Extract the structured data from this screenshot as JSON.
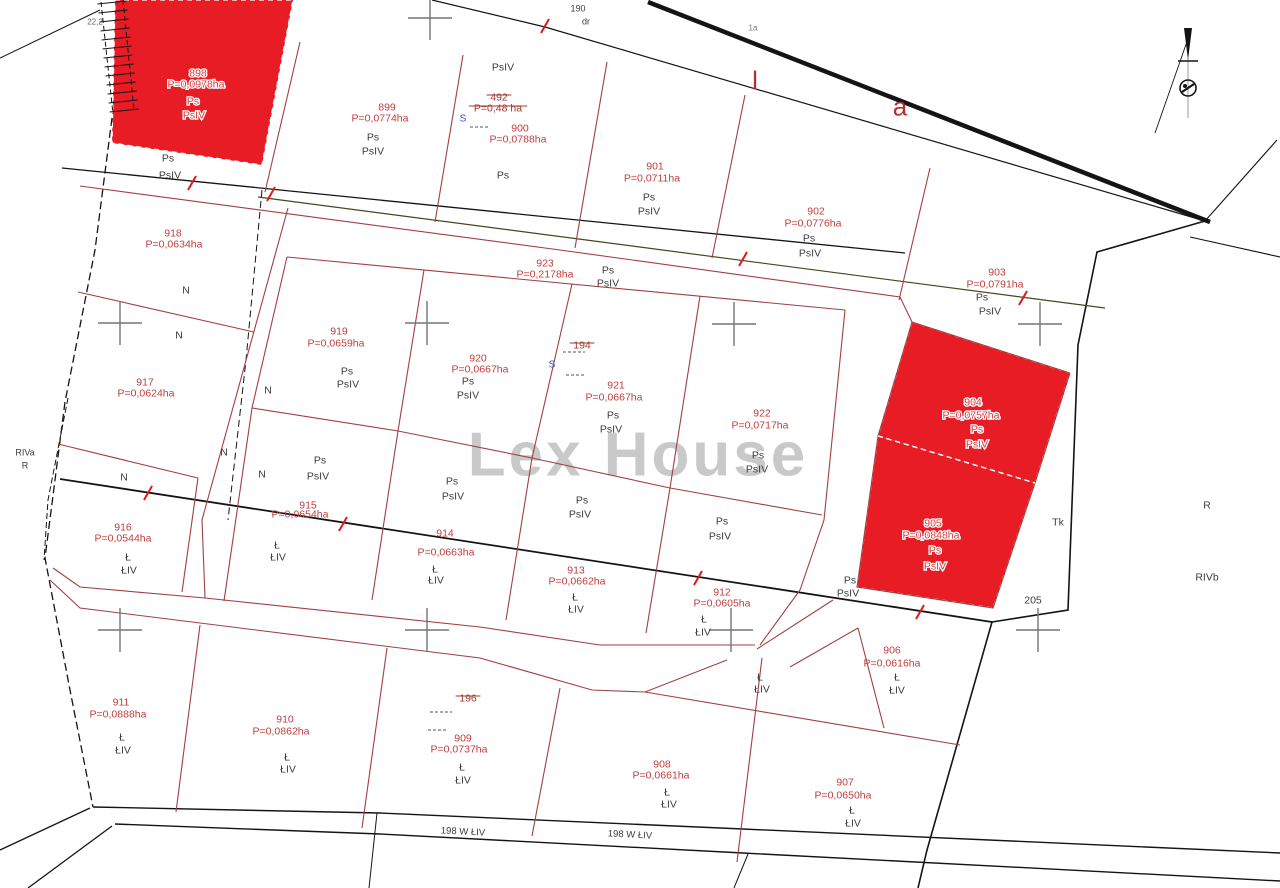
{
  "watermark": "Lex House",
  "colors": {
    "highlight_fill": "#e81c24",
    "parcel_line": "#a04040",
    "boundary": "#141414",
    "olive_line": "#46461e",
    "label_red": "#c13d3d",
    "label_black": "#3d3d3d",
    "cross": "#757575",
    "tick": "#e01818",
    "blue": "#3b4bc8",
    "tiny_gray": "#666666",
    "watermark_gray": "#b5b5b5"
  },
  "cross_size": 44,
  "highlighted_parcels": [
    {
      "number": "898",
      "area": "P=0,0978ha",
      "polygon": "115,0 293,0 262,165 112,143",
      "num_pos": [
        198,
        73
      ],
      "area_pos": [
        196,
        84
      ],
      "soils": [
        [
          "Ps",
          193,
          101
        ],
        [
          "PsIV",
          194,
          115
        ]
      ]
    },
    {
      "number": "904",
      "area": "P=0,0757ha",
      "polygon": "912,322 1070,373 1035,483 878,436",
      "num_pos": [
        973,
        402
      ],
      "area_pos": [
        971,
        415
      ],
      "soils": [
        [
          "Ps",
          977,
          429
        ],
        [
          "PsIV",
          977,
          444
        ]
      ]
    },
    {
      "number": "905",
      "area": "P=0,0848ha",
      "polygon": "878,436 1035,483 993,608 857,587",
      "num_pos": [
        933,
        523
      ],
      "area_pos": [
        931,
        535
      ],
      "soils": [
        [
          "Ps",
          935,
          550
        ],
        [
          "PsIV",
          935,
          566
        ]
      ]
    }
  ],
  "parcels": [
    {
      "n": "899",
      "a": "P=0,0774ha",
      "np": [
        387,
        107
      ],
      "ap": [
        380,
        118
      ],
      "s": [
        [
          "Ps",
          373,
          137
        ],
        [
          "PsIV",
          373,
          151
        ]
      ]
    },
    {
      "n": "900",
      "a": "P=0,0788ha",
      "np": [
        520,
        128
      ],
      "ap": [
        518,
        139
      ],
      "s": [
        [
          "Ps",
          503,
          175
        ]
      ]
    },
    {
      "n": "901",
      "a": "P=0,0711ha",
      "np": [
        655,
        166
      ],
      "ap": [
        652,
        178
      ],
      "s": [
        [
          "Ps",
          649,
          197
        ],
        [
          "PsIV",
          649,
          211
        ]
      ]
    },
    {
      "n": "902",
      "a": "P=0,0776ha",
      "np": [
        816,
        211
      ],
      "ap": [
        813,
        223
      ],
      "s": [
        [
          "Ps",
          809,
          238
        ],
        [
          "PsIV",
          810,
          253
        ]
      ]
    },
    {
      "n": "903",
      "a": "P=0,0791ha",
      "np": [
        997,
        272
      ],
      "ap": [
        995,
        284
      ],
      "s": [
        [
          "Ps",
          982,
          297
        ],
        [
          "PsIV",
          990,
          311
        ]
      ]
    },
    {
      "n": "923",
      "a": "P=0,2178ha",
      "np": [
        545,
        263
      ],
      "ap": [
        545,
        274
      ],
      "s": [
        [
          "Ps",
          608,
          270
        ],
        [
          "PsIV",
          608,
          283
        ]
      ]
    },
    {
      "n": "918",
      "a": "P=0,0634ha",
      "np": [
        173,
        233
      ],
      "ap": [
        174,
        244
      ],
      "s": []
    },
    {
      "n": "917",
      "a": "P=0,0624ha",
      "np": [
        145,
        382
      ],
      "ap": [
        146,
        393
      ],
      "s": []
    },
    {
      "n": "919",
      "a": "P=0,0659ha",
      "np": [
        339,
        331
      ],
      "ap": [
        336,
        343
      ],
      "s": [
        [
          "Ps",
          347,
          371
        ],
        [
          "PsIV",
          348,
          384
        ]
      ]
    },
    {
      "n": "920",
      "a": "P=0,0667ha",
      "np": [
        478,
        358
      ],
      "ap": [
        480,
        369
      ],
      "s": [
        [
          "Ps",
          468,
          381
        ],
        [
          "PsIV",
          468,
          395
        ]
      ]
    },
    {
      "n": "921",
      "a": "P=0,0667ha",
      "np": [
        616,
        385
      ],
      "ap": [
        614,
        397
      ],
      "s": [
        [
          "Ps",
          613,
          415
        ],
        [
          "PsIV",
          611,
          429
        ]
      ]
    },
    {
      "n": "922",
      "a": "P=0,0717ha",
      "np": [
        762,
        413
      ],
      "ap": [
        760,
        425
      ],
      "s": [
        [
          "Ps",
          758,
          455
        ],
        [
          "PsIV",
          757,
          469
        ]
      ]
    },
    {
      "n": "915",
      "a": "P=0,0654ha",
      "np": [
        308,
        505
      ],
      "ap": [
        300,
        514
      ],
      "s": [
        [
          "Ł",
          277,
          545
        ],
        [
          "ŁIV",
          278,
          557
        ]
      ]
    },
    {
      "n": "914",
      "a": "P=0,0663ha",
      "np": [
        445,
        533
      ],
      "ap": [
        446,
        552
      ],
      "s": [
        [
          "Ł",
          435,
          569
        ],
        [
          "ŁIV",
          436,
          580
        ]
      ]
    },
    {
      "n": "913",
      "a": "P=0,0662ha",
      "np": [
        576,
        570
      ],
      "ap": [
        577,
        581
      ],
      "s": [
        [
          "Ł",
          575,
          597
        ],
        [
          "ŁIV",
          576,
          609
        ]
      ]
    },
    {
      "n": "912",
      "a": "P=0,0605ha",
      "np": [
        722,
        592
      ],
      "ap": [
        722,
        603
      ],
      "s": [
        [
          "Ł",
          704,
          619
        ],
        [
          "ŁIV",
          703,
          632
        ]
      ]
    },
    {
      "n": "916",
      "a": "P=0,0544ha",
      "np": [
        123,
        527
      ],
      "ap": [
        123,
        538
      ],
      "s": [
        [
          "Ł",
          128,
          557
        ],
        [
          "ŁIV",
          129,
          570
        ]
      ]
    },
    {
      "n": "911",
      "a": "P=0,0888ha",
      "np": [
        121,
        702
      ],
      "ap": [
        118,
        714
      ],
      "s": [
        [
          "Ł",
          122,
          737
        ],
        [
          "ŁIV",
          123,
          750
        ]
      ]
    },
    {
      "n": "910",
      "a": "P=0,0862ha",
      "np": [
        285,
        719
      ],
      "ap": [
        281,
        731
      ],
      "s": [
        [
          "Ł",
          287,
          757
        ],
        [
          "ŁIV",
          288,
          769
        ]
      ]
    },
    {
      "n": "909",
      "a": "P=0,0737ha",
      "np": [
        463,
        738
      ],
      "ap": [
        459,
        749
      ],
      "s": [
        [
          "Ł",
          462,
          767
        ],
        [
          "ŁIV",
          463,
          780
        ]
      ]
    },
    {
      "n": "908",
      "a": "P=0,0661ha",
      "np": [
        662,
        764
      ],
      "ap": [
        661,
        775
      ],
      "s": [
        [
          "Ł",
          667,
          792
        ],
        [
          "ŁIV",
          669,
          804
        ]
      ]
    },
    {
      "n": "907",
      "a": "P=0,0650ha",
      "np": [
        845,
        782
      ],
      "ap": [
        843,
        795
      ],
      "s": [
        [
          "Ł",
          852,
          810
        ],
        [
          "ŁIV",
          853,
          823
        ]
      ]
    },
    {
      "n": "906",
      "a": "P=0,0616ha",
      "np": [
        892,
        650
      ],
      "ap": [
        892,
        663
      ],
      "s": [
        [
          "Ł",
          897,
          677
        ],
        [
          "ŁIV",
          897,
          690
        ]
      ]
    }
  ],
  "misc_labels": [
    {
      "t": "Ps",
      "x": 168,
      "y": 158
    },
    {
      "t": "PsIV",
      "x": 170,
      "y": 175
    },
    {
      "t": "PsIV",
      "x": 503,
      "y": 67
    },
    {
      "t": "N",
      "x": 186,
      "y": 290
    },
    {
      "t": "N",
      "x": 179,
      "y": 335
    },
    {
      "t": "N",
      "x": 268,
      "y": 390
    },
    {
      "t": "N",
      "x": 224,
      "y": 452
    },
    {
      "t": "N",
      "x": 124,
      "y": 477
    },
    {
      "t": "N",
      "x": 262,
      "y": 474
    },
    {
      "t": "Ps",
      "x": 320,
      "y": 460
    },
    {
      "t": "PsIV",
      "x": 318,
      "y": 476
    },
    {
      "t": "Ps",
      "x": 452,
      "y": 481
    },
    {
      "t": "PsIV",
      "x": 453,
      "y": 496
    },
    {
      "t": "Ps",
      "x": 582,
      "y": 500
    },
    {
      "t": "PsIV",
      "x": 580,
      "y": 514
    },
    {
      "t": "Ps",
      "x": 722,
      "y": 521
    },
    {
      "t": "PsIV",
      "x": 720,
      "y": 536
    },
    {
      "t": "Ps",
      "x": 850,
      "y": 580
    },
    {
      "t": "PsIV",
      "x": 848,
      "y": 593
    },
    {
      "t": "Ł",
      "x": 760,
      "y": 677
    },
    {
      "t": "ŁIV",
      "x": 762,
      "y": 689
    },
    {
      "t": "Tk",
      "x": 1058,
      "y": 522
    },
    {
      "t": "205",
      "x": 1033,
      "y": 600
    },
    {
      "t": "R",
      "x": 1207,
      "y": 505
    },
    {
      "t": "RIVb",
      "x": 1207,
      "y": 577
    },
    {
      "t": "RIVa",
      "x": 25,
      "y": 452,
      "fs": 9
    },
    {
      "t": "R",
      "x": 25,
      "y": 465,
      "fs": 9
    },
    {
      "t": "190",
      "x": 578,
      "y": 8,
      "fs": 9
    },
    {
      "t": "dr",
      "x": 586,
      "y": 21,
      "fs": 9
    },
    {
      "t": "22,2",
      "x": 95,
      "y": 21,
      "fs": 8,
      "c": "#666666"
    },
    {
      "t": "1a",
      "x": 753,
      "y": 27,
      "fs": 8,
      "c": "#777777"
    },
    {
      "t": "198 W ŁIV",
      "x": 463,
      "y": 831,
      "fs": 9.5,
      "rot": 3
    },
    {
      "t": "198 W ŁIV",
      "x": 630,
      "y": 834,
      "fs": 9.5,
      "rot": 3
    }
  ],
  "red_letters": [
    {
      "t": "l",
      "x": 755,
      "y": 86
    },
    {
      "t": "a",
      "x": 900,
      "y": 112
    }
  ],
  "struck_labels": [
    {
      "t": "492",
      "x": 499,
      "y": 97
    },
    {
      "t": "P=0,48 ha",
      "x": 498,
      "y": 108
    },
    {
      "t": "194",
      "x": 582,
      "y": 345
    },
    {
      "t": "196",
      "x": 468,
      "y": 698
    }
  ],
  "blue_marks": [
    {
      "t": "S",
      "x": 463,
      "y": 118
    },
    {
      "t": "S",
      "x": 552,
      "y": 364
    }
  ],
  "black_lines": [
    {
      "p": "648,2 1210,222",
      "w": 4.5,
      "name": "main-road-boundary-thick"
    },
    {
      "p": "432,0 545,27 1205,221",
      "w": 1.2,
      "name": "road-190-edge"
    },
    {
      "p": "1277,140 1205,221",
      "w": 1.1
    },
    {
      "p": "1190,237 1280,257",
      "w": 1.1
    },
    {
      "p": "1205,221 1097,252 1078,345 1068,610 992,622",
      "w": 1.6,
      "name": "east-boundary-upper"
    },
    {
      "p": "992,622 927,850 918,888",
      "w": 1.6,
      "name": "east-boundary-lower"
    },
    {
      "p": "62,168 905,253",
      "w": 1.3,
      "name": "north-zone-line"
    },
    {
      "p": "258,197 1105,308",
      "w": 1.2,
      "c": "#46461e",
      "name": "olive-boundary-line"
    },
    {
      "p": "60,479 992,622",
      "w": 1.8,
      "name": "soil-zone-line"
    },
    {
      "p": "262,190 246,360 228,520",
      "w": 1,
      "d": "7,4",
      "name": "old-boundary-dashed"
    },
    {
      "p": "112,118 95,250 65,402 45,558 70,690 93,807",
      "w": 1.3,
      "d": "8,4",
      "name": "west-boundary-dashed"
    },
    {
      "p": "68,398 48,500 44,560",
      "w": 1,
      "d": "6,3"
    },
    {
      "p": "93,807 380,813 743,829 1280,853",
      "w": 1.4,
      "name": "road-198-north-edge"
    },
    {
      "p": "115,824 380,834 743,853 1280,881",
      "w": 1.4,
      "name": "road-198-south-edge"
    },
    {
      "p": "90,808 0,850",
      "w": 1.3
    },
    {
      "p": "112,826 28,888",
      "w": 1.3
    },
    {
      "p": "377,813 369,888",
      "w": 1
    },
    {
      "p": "748,854 734,888",
      "w": 1
    },
    {
      "p": "0,58 100,10",
      "w": 1
    },
    {
      "p": "101,2 113,114",
      "w": 1,
      "d": "5,3",
      "name": "hatch-rail-west"
    },
    {
      "p": "123,0 134,110",
      "w": 1,
      "d": "5,3",
      "name": "hatch-rail-east"
    }
  ],
  "red_lines": [
    {
      "p": "300,42 265,192"
    },
    {
      "p": "463,55 435,222"
    },
    {
      "p": "607,62 575,248"
    },
    {
      "p": "745,95 712,258"
    },
    {
      "p": "930,168 899,300"
    },
    {
      "p": "80,186 560,250 900,297 912,322 1070,373",
      "name": "subdivision-north-line"
    },
    {
      "p": "287,257 845,310",
      "name": "inner-block-top"
    },
    {
      "p": "845,310 824,520 800,590 760,645",
      "name": "inner-block-right"
    },
    {
      "p": "224,601 252,408 287,257",
      "name": "inner-block-left"
    },
    {
      "p": "252,408 398,431 532,458 670,488 822,515",
      "name": "inner-block-midline"
    },
    {
      "p": "424,270 398,431"
    },
    {
      "p": "572,284 532,458"
    },
    {
      "p": "700,296 670,488"
    },
    {
      "p": "398,431 372,600"
    },
    {
      "p": "532,458 506,620"
    },
    {
      "p": "670,488 646,633"
    },
    {
      "p": "288,208 202,520 205,598",
      "name": "ring-road-west-outer"
    },
    {
      "p": "53,568 80,587 205,598 480,627 600,645 755,645",
      "name": "ring-road-bottom-inner"
    },
    {
      "p": "50,580 80,608 480,658 592,690 645,692 727,660",
      "name": "ring-road-bottom-outer"
    },
    {
      "p": "757,649 833,600"
    },
    {
      "p": "790,667 858,628"
    },
    {
      "p": "858,628 884,728"
    },
    {
      "p": "645,692 960,745",
      "name": "divider-906-907"
    },
    {
      "p": "762,658 737,862"
    },
    {
      "p": "78,292 254,332"
    },
    {
      "p": "58,444 198,478"
    },
    {
      "p": "198,478 182,592"
    },
    {
      "p": "200,625 176,812"
    },
    {
      "p": "387,648 362,828"
    },
    {
      "p": "560,688 532,836"
    },
    {
      "p": "912,322 878,436 857,587 993,608 1035,483 1070,373",
      "name": "red-parcels-outline"
    }
  ],
  "white_lines": [
    {
      "p": "878,436 1035,483"
    }
  ],
  "dash_marks": [
    {
      "p": "470,127 488,127"
    },
    {
      "p": "563,352 585,352"
    },
    {
      "p": "566,375 584,375"
    },
    {
      "p": "430,712 452,712"
    },
    {
      "p": "428,730 446,730"
    }
  ],
  "crosses": [
    [
      430,
      18
    ],
    [
      120,
      323
    ],
    [
      427,
      323
    ],
    [
      734,
      324
    ],
    [
      1040,
      324
    ],
    [
      120,
      630
    ],
    [
      427,
      630
    ],
    [
      731,
      630
    ],
    [
      1038,
      630
    ]
  ],
  "ticks": [
    [
      192,
      183
    ],
    [
      271,
      194
    ],
    [
      545,
      26
    ],
    [
      743,
      259
    ],
    [
      1023,
      298
    ],
    [
      148,
      493
    ],
    [
      343,
      524
    ],
    [
      698,
      578
    ],
    [
      920,
      612
    ]
  ],
  "hatch": {
    "x": 99,
    "y": 4,
    "count": 13,
    "step": 9,
    "dx": 13,
    "len": 27,
    "drop": 3
  },
  "symbol": {
    "cx": 1188,
    "cy": 88,
    "r": 8
  }
}
